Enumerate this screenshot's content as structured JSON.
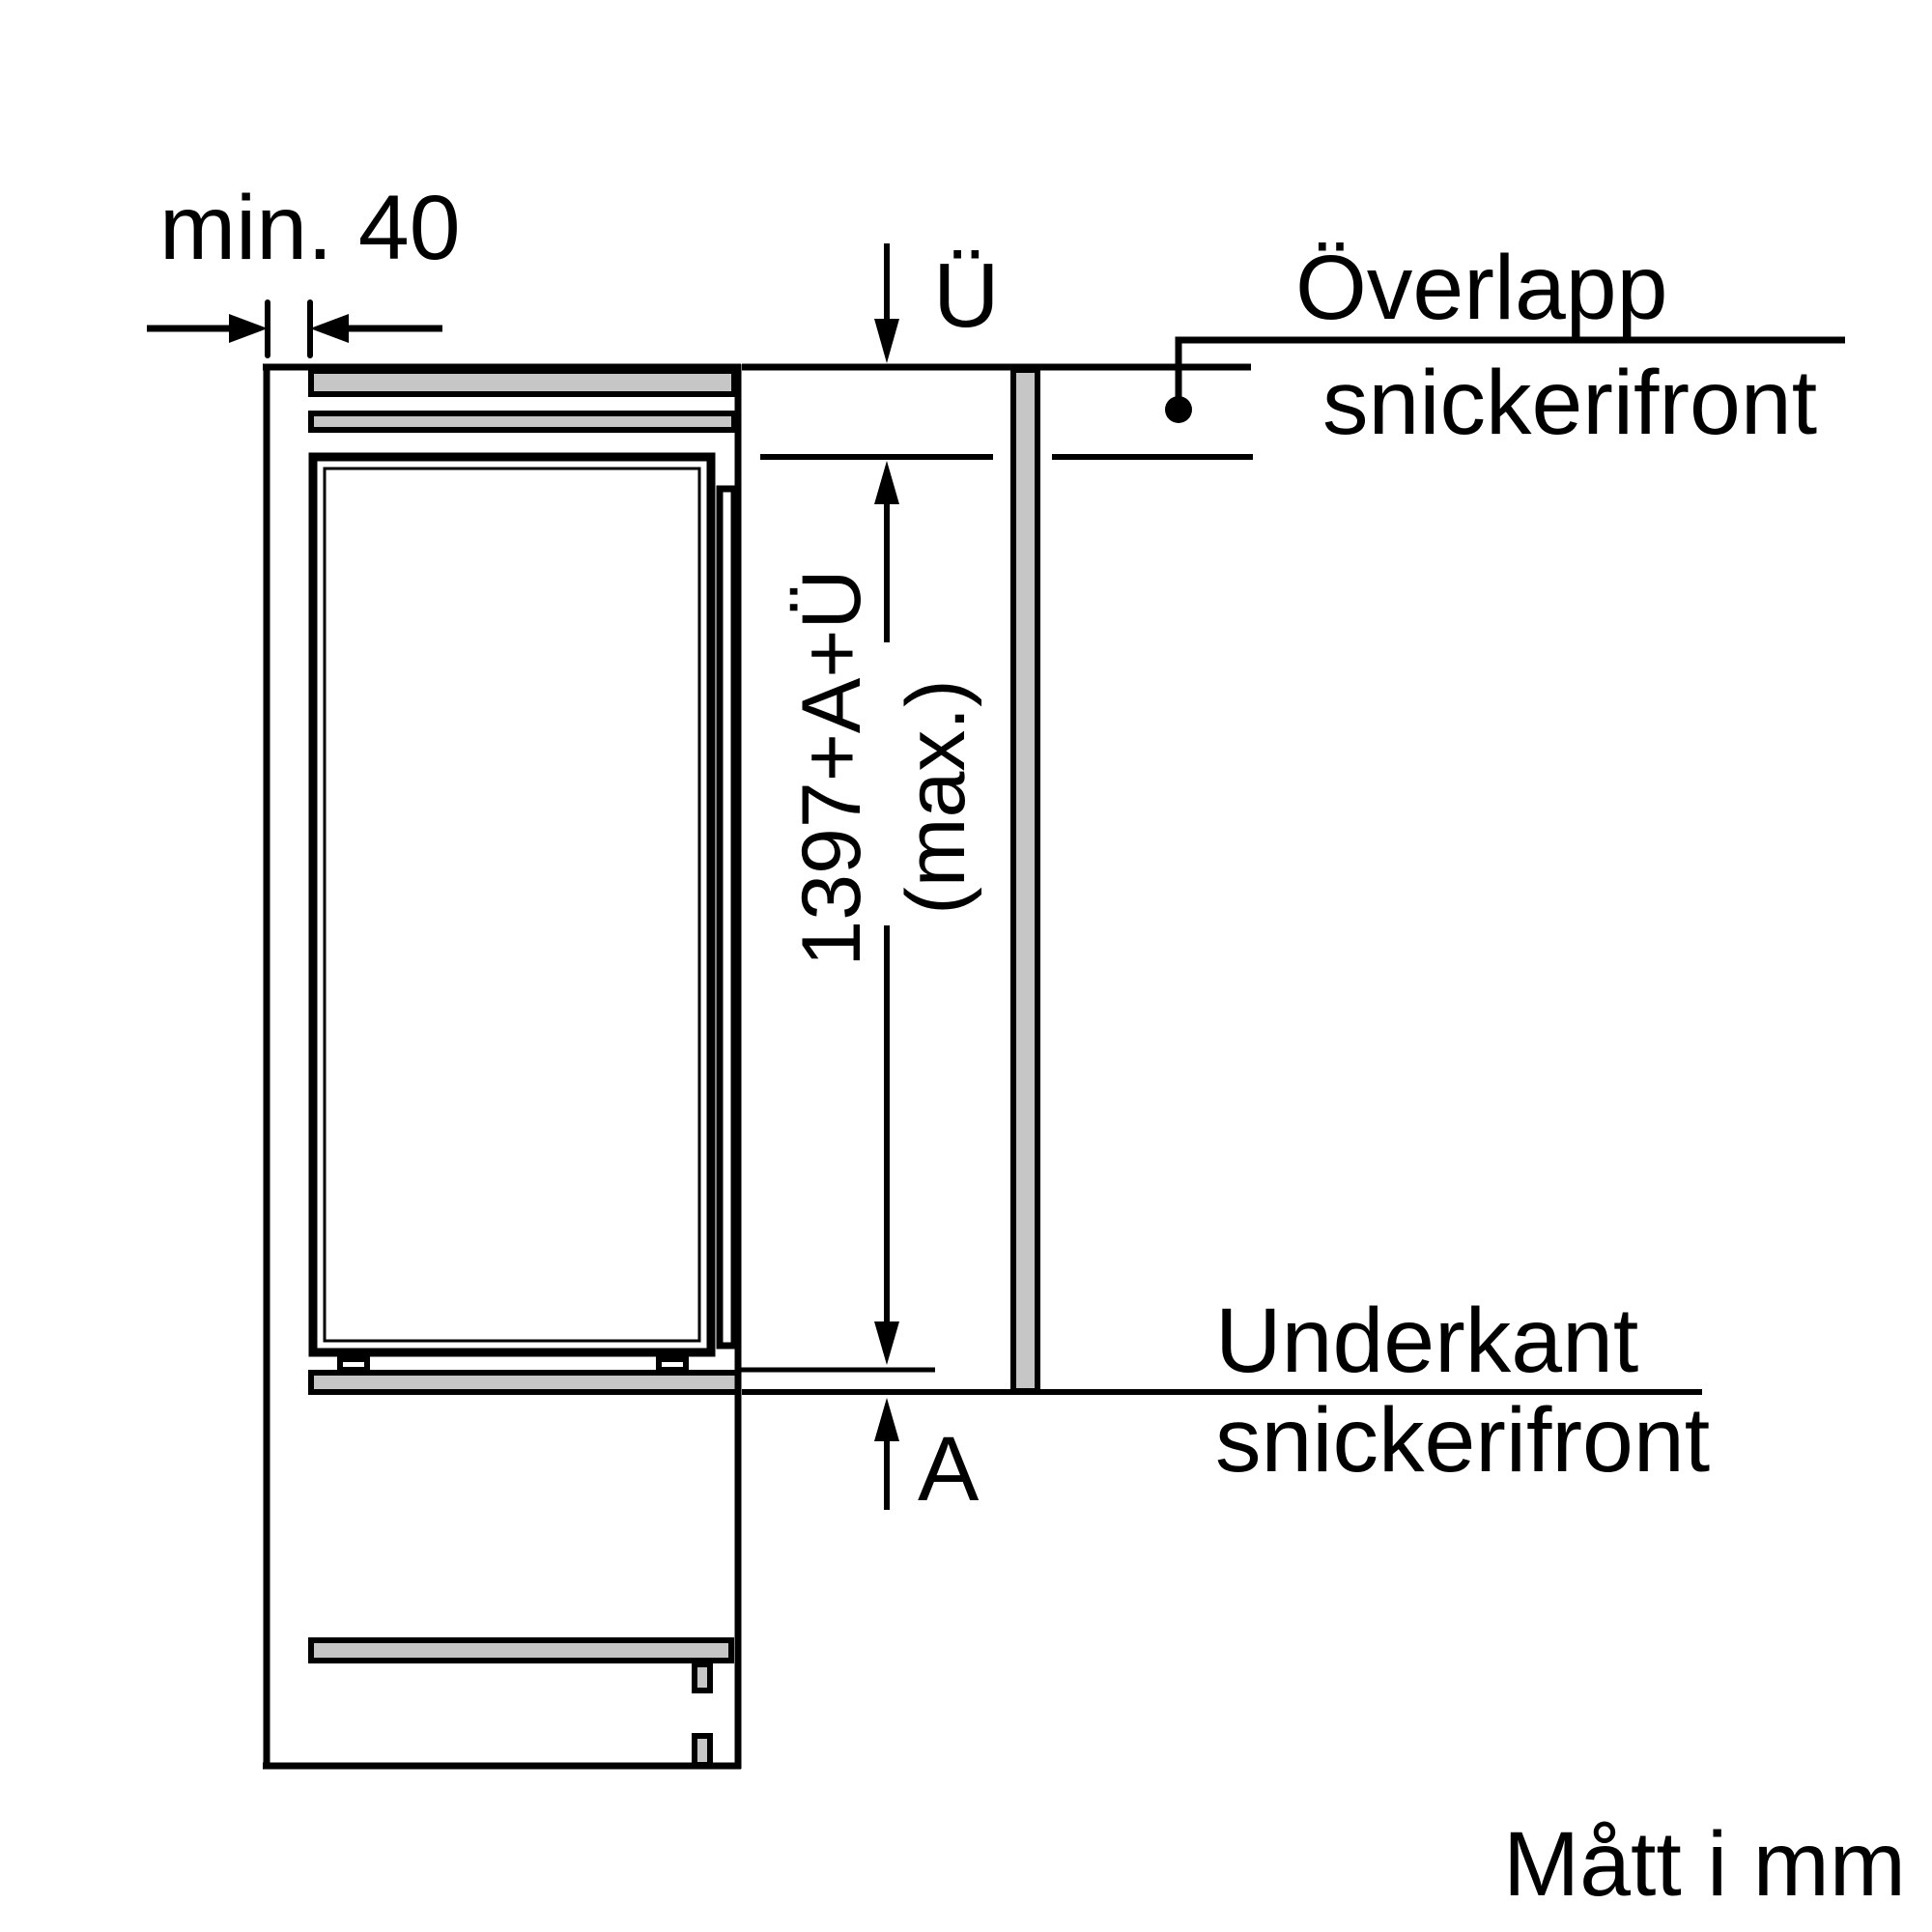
{
  "diagram_type": "appliance-installation-drawing",
  "labels": {
    "min_gap": "min. 40",
    "overlap_letter": "Ü",
    "overlap_line1": "Överlapp",
    "overlap_line2": "snickerifront",
    "height_formula": "1397+A+Ü",
    "height_max": "(max.)",
    "bottom_line1": "Underkant",
    "bottom_line2": "snickerifront",
    "recess_letter": "A",
    "footer": "Mått i mm"
  },
  "colors": {
    "line": "#000000",
    "panel_fill": "#c6c6c6",
    "background": "#ffffff"
  }
}
